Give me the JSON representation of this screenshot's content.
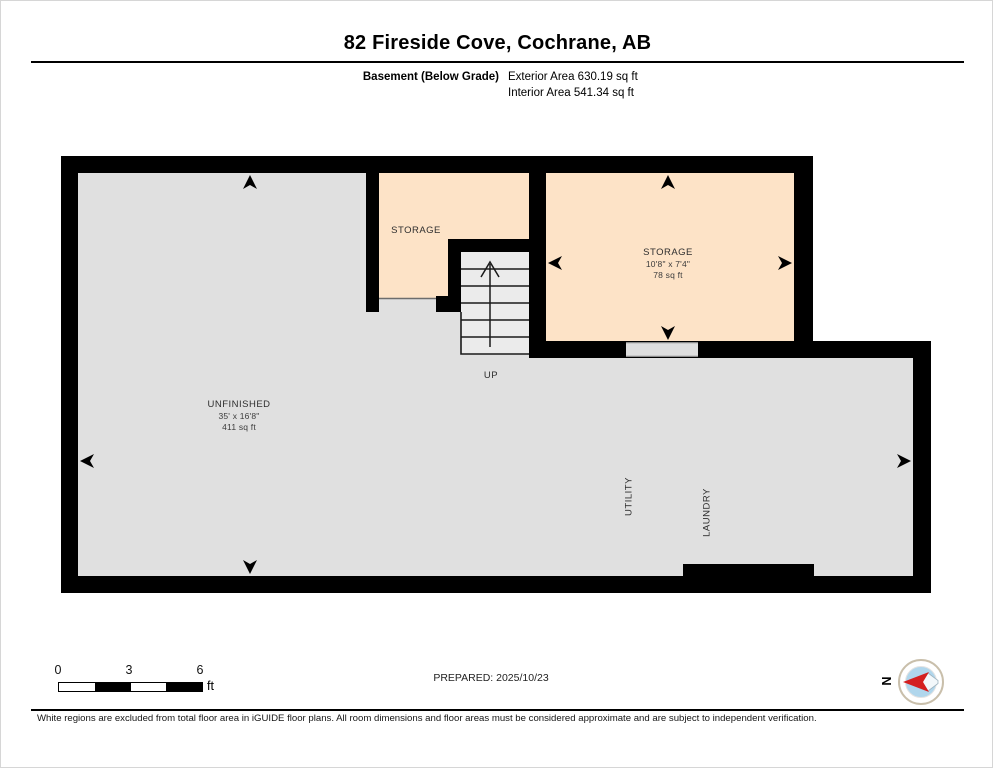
{
  "header": {
    "title": "82 Fireside Cove, Cochrane, AB",
    "floor_label": "Basement (Below Grade)",
    "exterior_area": "Exterior Area 630.19 sq ft",
    "interior_area": "Interior Area 541.34 sq ft"
  },
  "plan": {
    "rooms": {
      "storage_left": {
        "name": "STORAGE"
      },
      "storage_right": {
        "name": "STORAGE",
        "dims": "10'8\" x 7'4\"",
        "area": "78 sq ft"
      },
      "unfinished": {
        "name": "UNFINISHED",
        "dims": "35' x 16'8\"",
        "area": "411 sq ft"
      },
      "utility": {
        "name": "UTILITY"
      },
      "laundry": {
        "name": "LAUNDRY"
      }
    },
    "stairs": {
      "label": "UP"
    }
  },
  "footer": {
    "scale_bar": {
      "ticks": [
        "0",
        "3",
        "6"
      ],
      "unit": "ft"
    },
    "prepared": "PREPARED: 2025/10/23",
    "compass_label": "N",
    "disclaimer": "White regions are excluded from total floor area in iGUIDE floor plans. All room dimensions and floor areas must be considered approximate and are subject to independent verification."
  },
  "colors": {
    "wall": "#000000",
    "room_fill": "#fde3c7",
    "excluded_fill": "#e0e0e0",
    "stair_fill": "#ebebeb",
    "threshold_fill": "#dedede",
    "compass_ring": "#c9bfab",
    "compass_blue": "#b0d6ec",
    "compass_red": "#d42020"
  }
}
